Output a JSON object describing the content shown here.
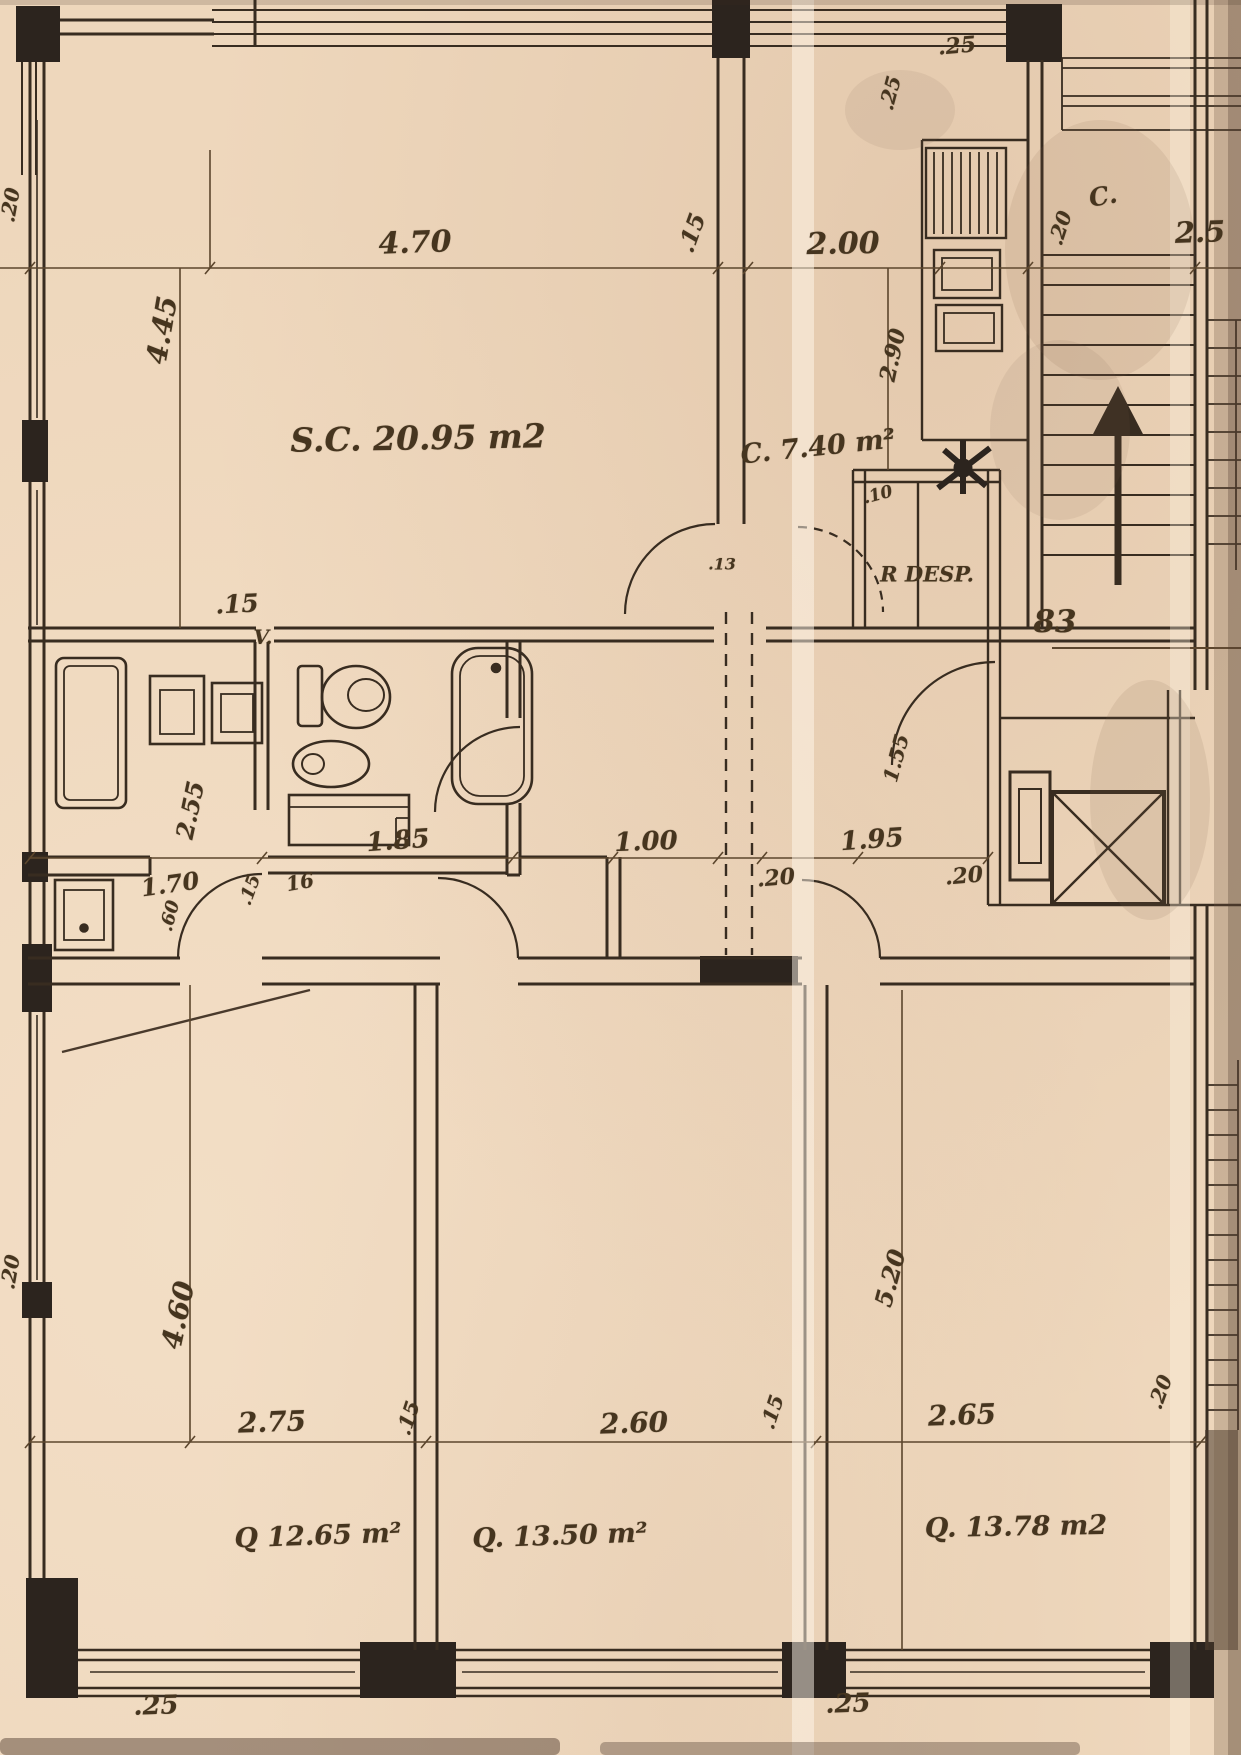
{
  "document": {
    "kind": "scanned architectural floor plan",
    "paper_color": "#eed7bc",
    "ink_color": "#382c20",
    "dim_color": "#5c462d"
  },
  "rooms": {
    "living_dining": "S.C. 20.95 m2",
    "kitchen": "C. 7.40 m²",
    "pantry": "R DESP.",
    "vent_shaft": "V.",
    "bedroom_1": "Q 12.65 m²",
    "bedroom_2": "Q. 13.50 m²",
    "bedroom_3": "Q. 13.78 m2",
    "landing_closet": "C.",
    "unit_number": "83"
  },
  "labels": [
    {
      "name": "dim-470",
      "text": "4.70",
      "x": 415,
      "y": 243,
      "rot": -2,
      "size": 30
    },
    {
      "name": "dim-15-top",
      "text": ".15",
      "x": 692,
      "y": 233,
      "rot": -70,
      "size": 23
    },
    {
      "name": "dim-200",
      "text": "2.00",
      "x": 843,
      "y": 244,
      "rot": -1,
      "size": 30
    },
    {
      "name": "dim-25-top",
      "text": ".25",
      "x": 957,
      "y": 46,
      "rot": -5,
      "size": 22
    },
    {
      "name": "dim-25-top-vert",
      "text": ".25",
      "x": 890,
      "y": 93,
      "rot": -75,
      "size": 20
    },
    {
      "name": "label-c-landing",
      "text": "C.",
      "x": 1103,
      "y": 196,
      "rot": -10,
      "size": 25
    },
    {
      "name": "dim-20-top-right",
      "text": ".20",
      "x": 1060,
      "y": 228,
      "rot": -72,
      "size": 20
    },
    {
      "name": "dim-250-right",
      "text": "2.5",
      "x": 1200,
      "y": 232,
      "rot": -2,
      "size": 29
    },
    {
      "name": "dim-445",
      "text": "4.45",
      "x": 162,
      "y": 330,
      "rot": -80,
      "size": 28
    },
    {
      "name": "room-living",
      "text": "S.C. 20.95 m2",
      "x": 418,
      "y": 438,
      "rot": -1,
      "size": 33
    },
    {
      "name": "room-kitchen",
      "text": "C. 7.40 m²",
      "x": 818,
      "y": 447,
      "rot": -6,
      "size": 27
    },
    {
      "name": "dim-290",
      "text": "2.90",
      "x": 893,
      "y": 355,
      "rot": -78,
      "size": 22
    },
    {
      "name": "dim-10",
      "text": ".10",
      "x": 878,
      "y": 495,
      "rot": -15,
      "size": 17
    },
    {
      "name": "room-pantry",
      "text": "R DESP.",
      "x": 927,
      "y": 574,
      "rot": 0,
      "size": 21
    },
    {
      "name": "dim-15-bath",
      "text": ".15",
      "x": 237,
      "y": 604,
      "rot": -3,
      "size": 25
    },
    {
      "name": "label-vent",
      "text": "V.",
      "x": 263,
      "y": 637,
      "rot": 0,
      "size": 20
    },
    {
      "name": "dim-13-hall",
      "text": ".13",
      "x": 722,
      "y": 564,
      "rot": 0,
      "size": 16
    },
    {
      "name": "dim-155-hall",
      "text": "1.55",
      "x": 896,
      "y": 758,
      "rot": -75,
      "size": 20
    },
    {
      "name": "label-unit-83",
      "text": "83",
      "x": 1055,
      "y": 622,
      "rot": 0,
      "size": 31
    },
    {
      "name": "dim-255",
      "text": "2.55",
      "x": 190,
      "y": 810,
      "rot": -78,
      "size": 24
    },
    {
      "name": "dim-185",
      "text": "1.85",
      "x": 398,
      "y": 841,
      "rot": -4,
      "size": 26
    },
    {
      "name": "dim-100",
      "text": "1.00",
      "x": 646,
      "y": 842,
      "rot": -2,
      "size": 26
    },
    {
      "name": "dim-195",
      "text": "1.95",
      "x": 872,
      "y": 840,
      "rot": -4,
      "size": 26
    },
    {
      "name": "dim-170",
      "text": "1.70",
      "x": 170,
      "y": 884,
      "rot": -8,
      "size": 24
    },
    {
      "name": "dim-15-lobby",
      "text": ".15",
      "x": 250,
      "y": 890,
      "rot": -70,
      "size": 18
    },
    {
      "name": "dim-16",
      "text": "16",
      "x": 300,
      "y": 882,
      "rot": -10,
      "size": 20
    },
    {
      "name": "dim-20-hall-l",
      "text": ".20",
      "x": 776,
      "y": 878,
      "rot": -5,
      "size": 22
    },
    {
      "name": "dim-20-hall-r",
      "text": ".20",
      "x": 964,
      "y": 876,
      "rot": -5,
      "size": 22
    },
    {
      "name": "dim-60",
      "text": ".60",
      "x": 170,
      "y": 916,
      "rot": -75,
      "size": 18
    },
    {
      "name": "dim-460",
      "text": "4.60",
      "x": 178,
      "y": 1315,
      "rot": -78,
      "size": 28
    },
    {
      "name": "dim-520",
      "text": "5.20",
      "x": 890,
      "y": 1278,
      "rot": -75,
      "size": 24
    },
    {
      "name": "dim-20-right-mid",
      "text": ".20",
      "x": 1160,
      "y": 1392,
      "rot": -70,
      "size": 20
    },
    {
      "name": "dim-275",
      "text": "2.75",
      "x": 272,
      "y": 1422,
      "rot": -2,
      "size": 28
    },
    {
      "name": "dim-15-bed1",
      "text": ".15",
      "x": 408,
      "y": 1418,
      "rot": -72,
      "size": 20
    },
    {
      "name": "dim-260",
      "text": "2.60",
      "x": 634,
      "y": 1423,
      "rot": -2,
      "size": 28
    },
    {
      "name": "dim-15-bed2",
      "text": ".15",
      "x": 772,
      "y": 1412,
      "rot": -72,
      "size": 20
    },
    {
      "name": "dim-265",
      "text": "2.65",
      "x": 962,
      "y": 1415,
      "rot": -2,
      "size": 28
    },
    {
      "name": "room-bedroom-1",
      "text": "Q 12.65 m²",
      "x": 318,
      "y": 1536,
      "rot": -2,
      "size": 27
    },
    {
      "name": "room-bedroom-2",
      "text": "Q. 13.50 m²",
      "x": 560,
      "y": 1536,
      "rot": -2,
      "size": 27
    },
    {
      "name": "room-bedroom-3",
      "text": "Q. 13.78 m2",
      "x": 1016,
      "y": 1527,
      "rot": -1,
      "size": 27
    },
    {
      "name": "dim-25-bottom-l",
      "text": ".25",
      "x": 156,
      "y": 1706,
      "rot": -2,
      "size": 26
    },
    {
      "name": "dim-25-bottom-r",
      "text": ".25",
      "x": 848,
      "y": 1704,
      "rot": -2,
      "size": 26
    },
    {
      "name": "dim-20-left-top",
      "text": ".20",
      "x": 10,
      "y": 205,
      "rot": -80,
      "size": 20
    },
    {
      "name": "dim-20-left-bot",
      "text": ".20",
      "x": 10,
      "y": 1272,
      "rot": -80,
      "size": 20
    }
  ]
}
